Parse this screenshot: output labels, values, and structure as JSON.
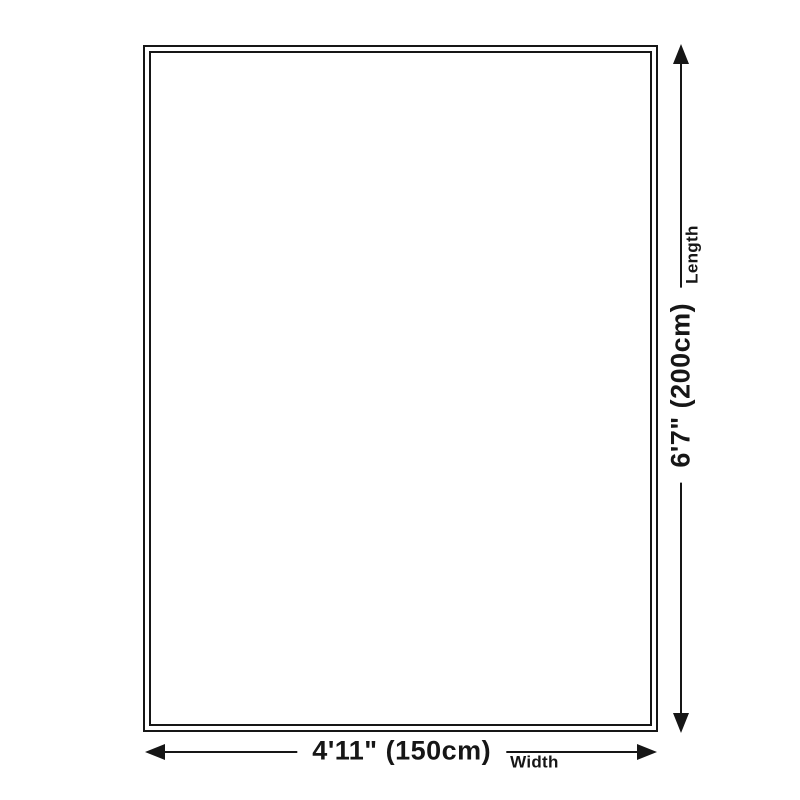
{
  "diagram": {
    "background_color": "#ffffff",
    "line_color": "#161616",
    "length": {
      "value": "6'7\" (200cm)",
      "label": "Length"
    },
    "width": {
      "value": "4'11\" (150cm)",
      "label": "Width"
    }
  }
}
